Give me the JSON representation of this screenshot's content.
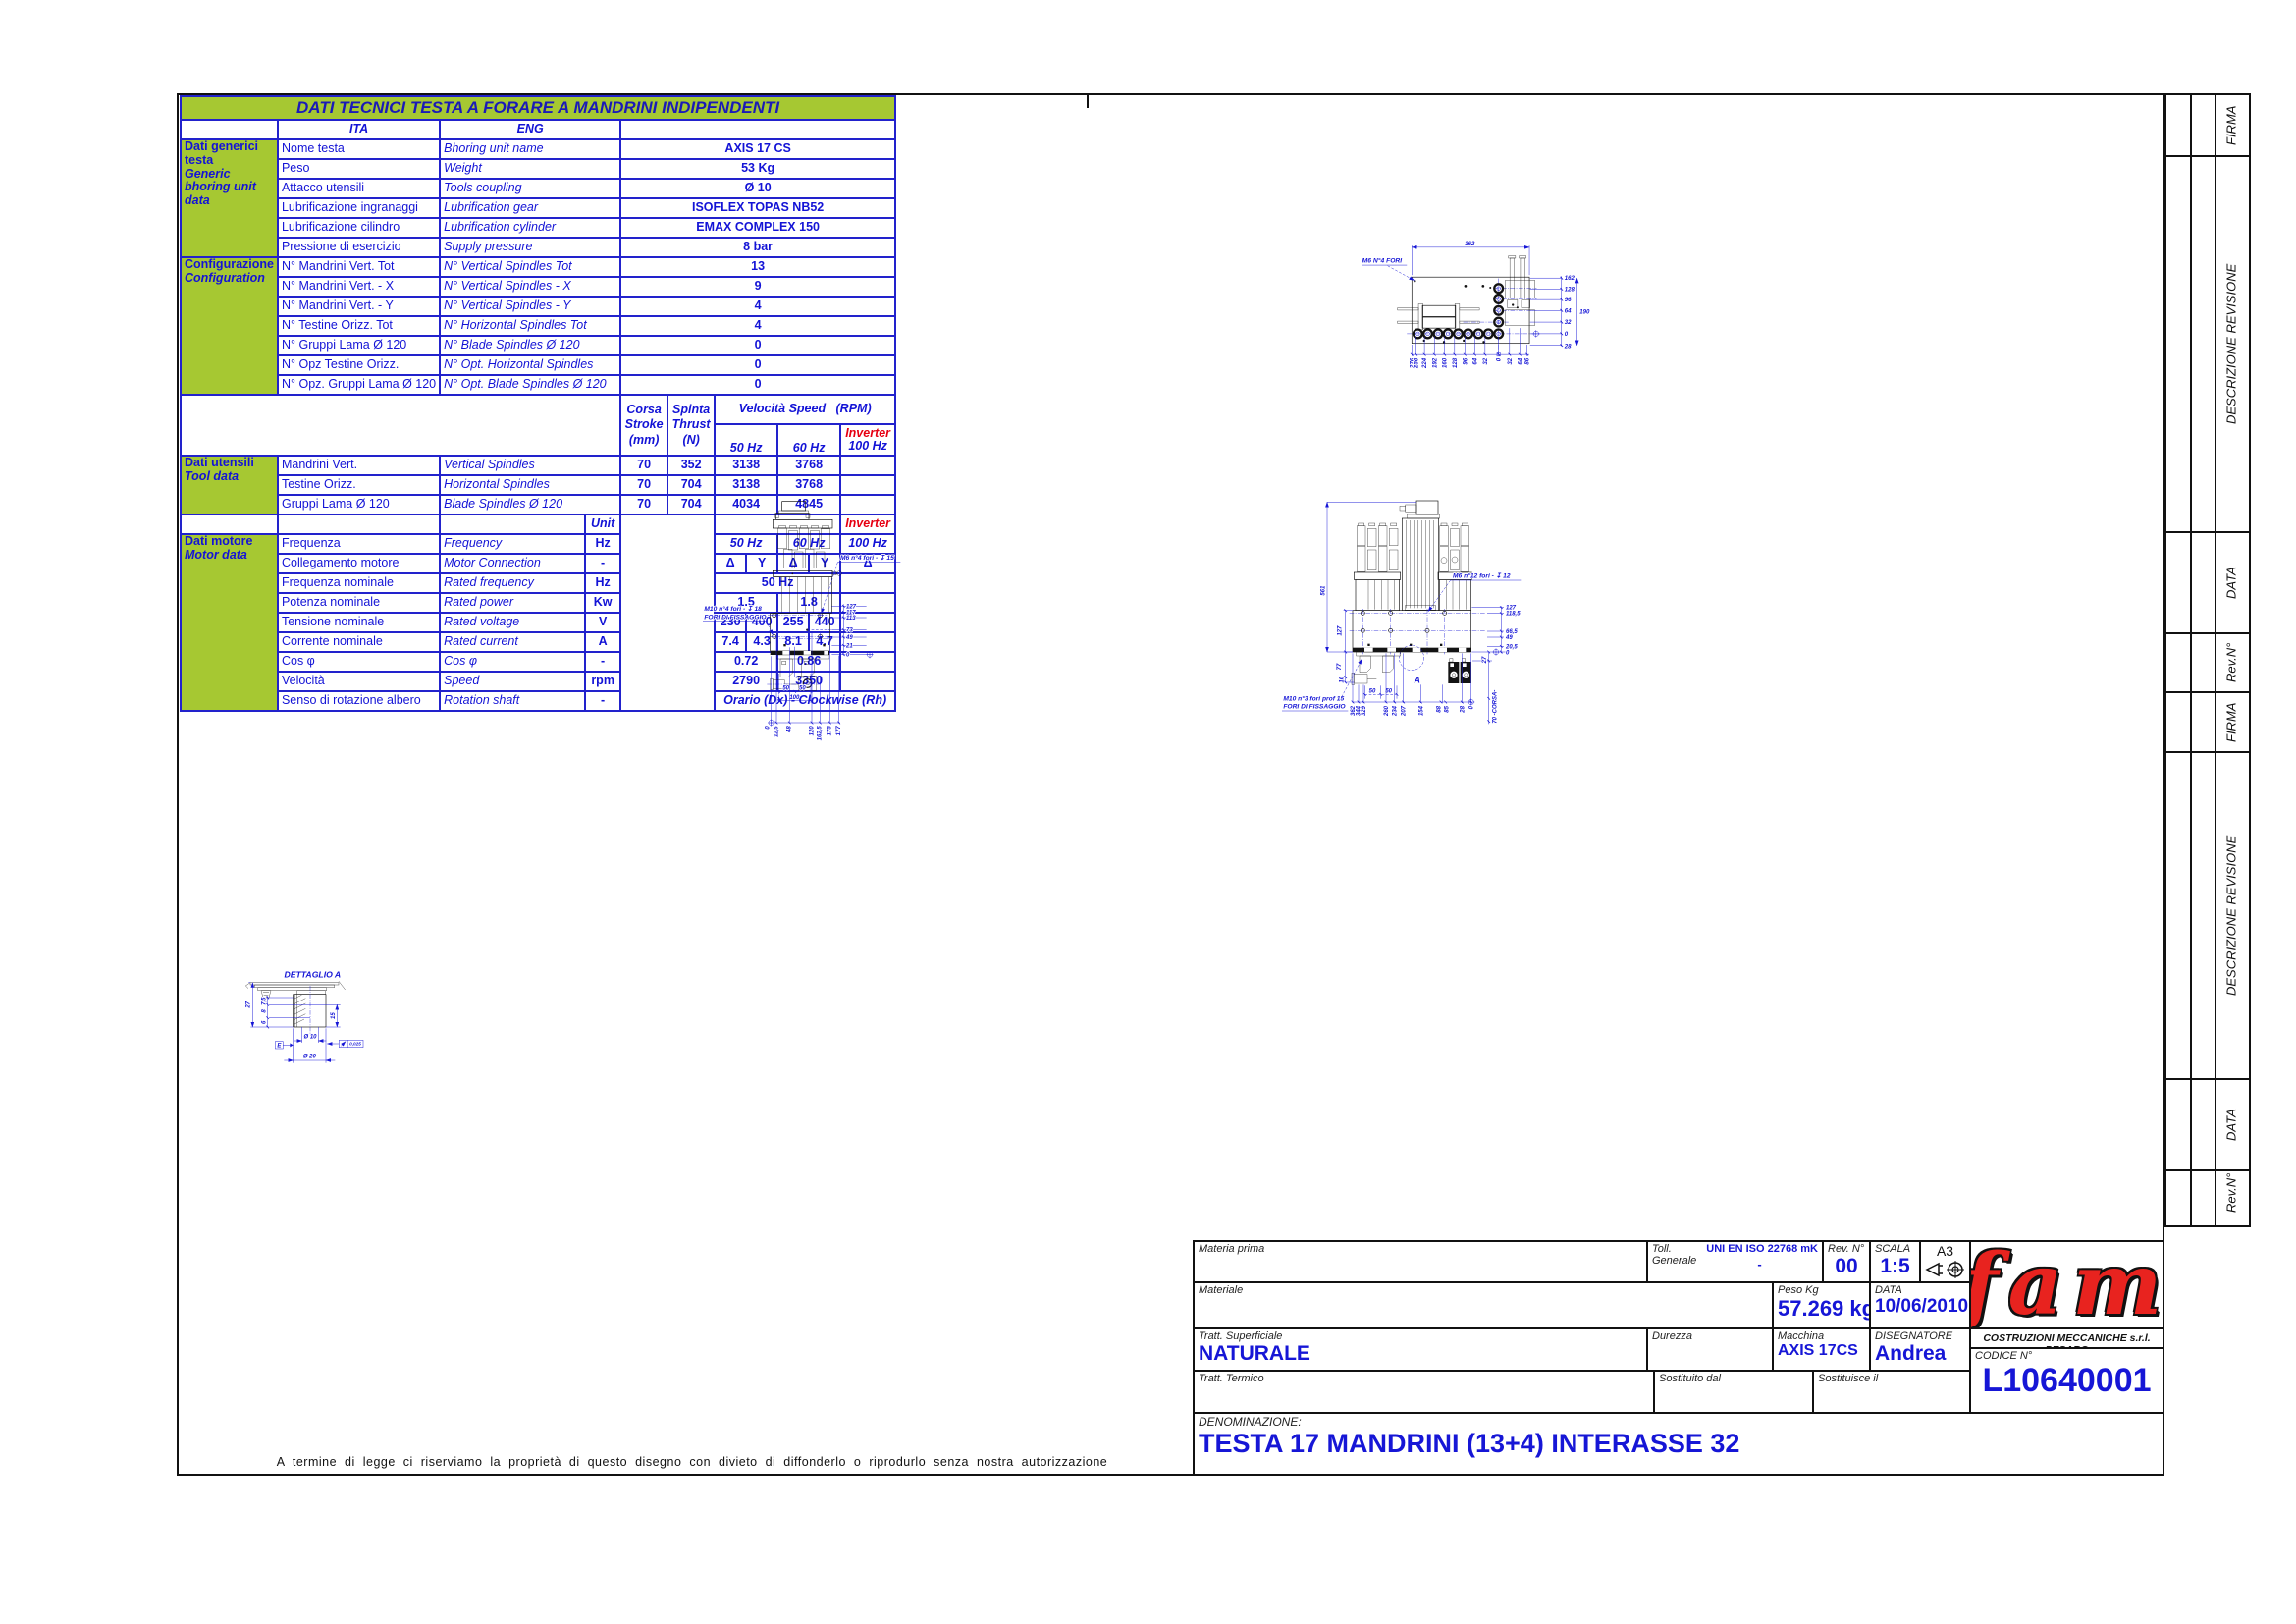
{
  "table": {
    "title": "DATI TECNICI TESTA A FORARE A MANDRINI INDIPENDENTI",
    "headers": {
      "ita": "ITA",
      "eng": "ENG",
      "unit": "Unit",
      "corsa1": "Corsa",
      "corsa2": "Stroke",
      "corsa3": "(mm)",
      "spinta1": "Spinta",
      "spinta2": "Thrust",
      "spinta3": "(N)",
      "velocita": "Velocità Speed",
      "rpm": "(RPM)",
      "hz50": "50 Hz",
      "hz60": "60 Hz",
      "inverter": "Inverter",
      "hz100": "100 Hz"
    },
    "groups": {
      "generic_ita": "Dati generici testa",
      "generic_eng": "Generic bhoring unit data",
      "config_ita": "Configurazione",
      "config_eng": "Configuration",
      "tool_ita": "Dati utensili",
      "tool_eng": "Tool data",
      "motor_ita": "Dati motore",
      "motor_eng": "Motor data"
    },
    "generic_rows": [
      {
        "ita": "Nome testa",
        "eng": "Bhoring unit name",
        "value": "AXIS 17 CS"
      },
      {
        "ita": "Peso",
        "eng": "Weight",
        "value": "53 Kg"
      },
      {
        "ita": "Attacco utensili",
        "eng": "Tools coupling",
        "value": "Ø 10"
      },
      {
        "ita": "Lubrificazione ingranaggi",
        "eng": "Lubrification gear",
        "value": "ISOFLEX TOPAS NB52"
      },
      {
        "ita": "Lubrificazione cilindro",
        "eng": "Lubrification cylinder",
        "value": "EMAX COMPLEX 150"
      },
      {
        "ita": "Pressione di esercizio",
        "eng": "Supply pressure",
        "value": "8 bar"
      }
    ],
    "config_rows": [
      {
        "ita": "N° Mandrini Vert. Tot",
        "eng": "N° Vertical Spindles Tot",
        "value": "13"
      },
      {
        "ita": "N° Mandrini Vert. - X",
        "eng": "N° Vertical Spindles - X",
        "value": "9"
      },
      {
        "ita": "N° Mandrini Vert. - Y",
        "eng": "N° Vertical Spindles - Y",
        "value": "4"
      },
      {
        "ita": "N° Testine Orizz. Tot",
        "eng": "N° Horizontal Spindles Tot",
        "value": "4"
      },
      {
        "ita": "N° Gruppi Lama Ø 120",
        "eng": "N° Blade Spindles Ø 120",
        "value": "0"
      },
      {
        "ita": "N° Opz Testine Orizz.",
        "eng": "N° Opt. Horizontal Spindles",
        "value": "0"
      },
      {
        "ita": "N° Opz. Gruppi Lama Ø 120",
        "eng": "N° Opt. Blade Spindles Ø 120",
        "value": "0"
      }
    ],
    "tool_rows": [
      {
        "ita": "Mandrini Vert.",
        "eng": "Vertical Spindles",
        "corsa": "70",
        "spinta": "352",
        "hz50": "3138",
        "hz60": "3768"
      },
      {
        "ita": "Testine Orizz.",
        "eng": "Horizontal Spindles",
        "corsa": "70",
        "spinta": "704",
        "hz50": "3138",
        "hz60": "3768"
      },
      {
        "ita": "Gruppi Lama Ø 120",
        "eng": "Blade Spindles Ø 120",
        "corsa": "70",
        "spinta": "704",
        "hz50": "4034",
        "hz60": "4845"
      }
    ],
    "motor": {
      "frequenza": {
        "ita": "Frequenza",
        "eng": "Frequency",
        "unit": "Hz",
        "v50": "50 Hz",
        "v60": "60 Hz",
        "inv": "100 Hz"
      },
      "collegamento": {
        "ita": "Collegamento motore",
        "eng": "Motor Connection",
        "unit": "-",
        "a": "Δ",
        "b": "Y",
        "c": "Δ",
        "d": "Y",
        "inv": "Δ"
      },
      "freq_nom": {
        "ita": "Frequenza nominale",
        "eng": "Rated frequency",
        "unit": "Hz",
        "value": "50 Hz"
      },
      "potenza": {
        "ita": "Potenza nominale",
        "eng": "Rated power",
        "unit": "Kw",
        "v50": "1.5",
        "v60": "1.8"
      },
      "tensione": {
        "ita": "Tensione nominale",
        "eng": "Rated voltage",
        "unit": "V",
        "a": "230",
        "b": "400",
        "c": "255",
        "d": "440"
      },
      "corrente": {
        "ita": "Corrente nominale",
        "eng": "Rated current",
        "unit": "A",
        "a": "7.4",
        "b": "4.3",
        "c": "8.1",
        "d": "4.7"
      },
      "cos": {
        "ita": "Cos φ",
        "eng": "Cos φ",
        "unit": "-",
        "v50": "0.72",
        "v60": "0.86"
      },
      "velocita": {
        "ita": "Velocità",
        "eng": "Speed",
        "unit": "rpm",
        "v50": "2790",
        "v60": "3350"
      },
      "senso": {
        "ita": "Senso di rotazione albero",
        "eng": "Rotation shaft",
        "unit": "-",
        "value": "Orario (Dx) - Clockwise (Rh)"
      }
    }
  },
  "views": {
    "top": {
      "label": "M6 N°4 FORI",
      "width": "362",
      "height": "190",
      "below": "28",
      "right": [
        "162",
        "128",
        "96",
        "64",
        "32",
        "0"
      ],
      "bottom": [
        "276",
        "256",
        "224",
        "192",
        "160",
        "128",
        "96",
        "64",
        "32",
        "0",
        "32",
        "64",
        "86"
      ]
    },
    "front": {
      "m6": "M6   n°4 fori - ↧ 15",
      "m10": "M10   n°4 fori - ↧ 18",
      "fix": "FORI DI FISSAGGIO",
      "right": [
        "127",
        "117",
        "113",
        "73",
        "49",
        "21",
        "0"
      ],
      "bottom": [
        "0",
        "12,5",
        "48",
        "120",
        "162,5",
        "175",
        "177"
      ],
      "d50a": "50",
      "d50b": "50",
      "d100": "100"
    },
    "side": {
      "height": "561",
      "m6": "M6   n°12 fori - ↧ 12",
      "m10": "M10 n°3 fori prof 15",
      "fix": "FORI DI FISSAGGIO",
      "right": [
        "127",
        "118,5",
        "66,5",
        "49",
        "20,5",
        "0"
      ],
      "d27": "27",
      "corsa": "70  -CORSA-",
      "left": [
        "127",
        "77",
        "16"
      ],
      "bottom": [
        "362",
        "344",
        "329",
        "260",
        "234",
        "207",
        "154",
        "88",
        "85",
        "28",
        "0"
      ],
      "d50a": "50",
      "d50b": "50",
      "detail_mark": "A"
    },
    "detail": {
      "title": "DETTAGLIO A",
      "d27": "27",
      "d75": "7,5",
      "d8": "8",
      "d6": "6",
      "d15": "15",
      "dia10": "Ø 10",
      "dia20": "Ø 20",
      "datum": "E",
      "tol": "0,025"
    }
  },
  "strip": {
    "firma": "FIRMA",
    "descrizione": "DESCRIZIONE REVISIONE",
    "data": "DATA",
    "rev": "Rev.N°"
  },
  "titleblock": {
    "materia_prima_label": "Materia prima",
    "materiale_label": "Materiale",
    "tratt_sup_label": "Tratt. Superficiale",
    "tratt_sup_value": "NATURALE",
    "tratt_termico_label": "Tratt. Termico",
    "toll_label1": "Toll.",
    "toll_label2": "Generale",
    "toll_value": "UNI EN ISO 22768 mK",
    "toll_dash": "-",
    "rev_label": "Rev. N°",
    "rev_value": "00",
    "scala_label": "SCALA",
    "scala_value": "1:5",
    "format": "A3",
    "peso_label": "Peso Kg",
    "peso_value": "57.269 kg",
    "data_label": "DATA",
    "data_value": "10/06/2010",
    "durezza_label": "Durezza",
    "macchina_label": "Macchina",
    "macchina_value": "AXIS 17CS",
    "disegnatore_label": "DISEGNATORE",
    "disegnatore_value": "Andrea",
    "sostituito_label": "Sostituito dal",
    "sostituisce_label": "Sostituisce il",
    "company": "COSTRUZIONI MECCANICHE s.r.l. PESARO",
    "codice_label": "CODICE N°",
    "codice_value": "L10640001",
    "denominazione_label": "DENOMINAZIONE:",
    "denominazione_value": "TESTA 17 MANDRINI (13+4) INTERASSE 32",
    "logo": "fam"
  },
  "legal": "A termine di legge ci riserviamo la proprietà di questo disegno con divieto di diffonderlo o riprodurlo senza nostra autorizzazione"
}
